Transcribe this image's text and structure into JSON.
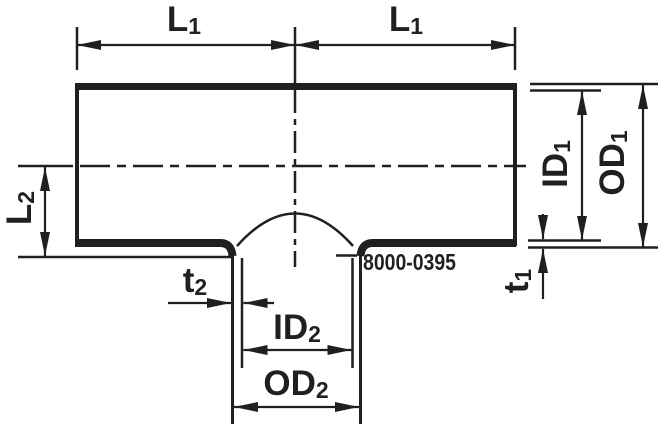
{
  "diagram": {
    "title": "tee-fitting-dimension-drawing",
    "part_number": "8000-0395",
    "labels": {
      "l1": {
        "base": "L",
        "sub": "1"
      },
      "l2": {
        "base": "L",
        "sub": "2"
      },
      "id1": {
        "base": "ID",
        "sub": "1"
      },
      "od1": {
        "base": "OD",
        "sub": "1"
      },
      "t1": {
        "base": "t",
        "sub": "1"
      },
      "t2": {
        "base": "t",
        "sub": "2"
      },
      "id2": {
        "base": "ID",
        "sub": "2"
      },
      "od2": {
        "base": "OD",
        "sub": "2"
      }
    },
    "colors": {
      "line": "#231f20",
      "background": "#ffffff"
    }
  }
}
